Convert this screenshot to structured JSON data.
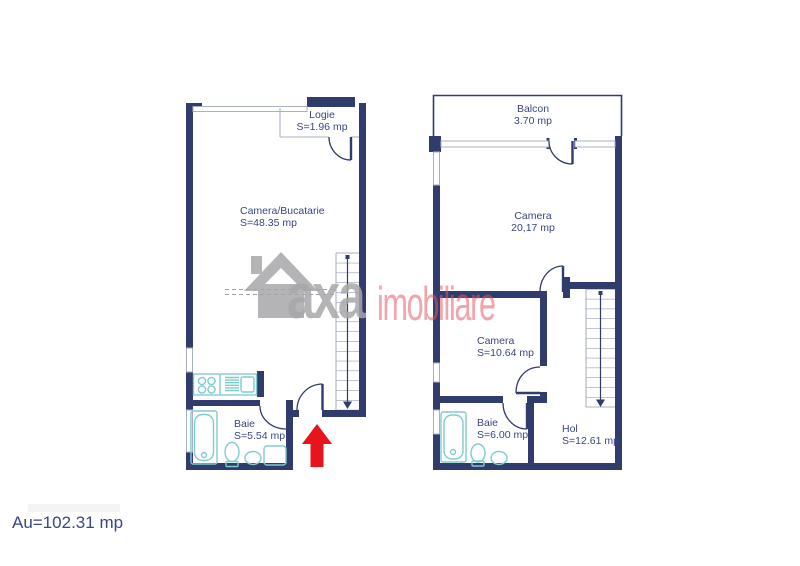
{
  "footer": {
    "total_area": "Au=102.31 mp"
  },
  "watermark": {
    "icon": "house-icon",
    "brand_primary": "axa",
    "brand_secondary": "imobiliare"
  },
  "entrance": {
    "icon": "up-arrow-icon",
    "color": "#e8141c"
  },
  "plans": {
    "lower": {
      "name": "lower-floor-plan",
      "rooms": [
        {
          "id": "logie",
          "label": "Logie",
          "area": "S=1.96 mp"
        },
        {
          "id": "camera_bucatarie",
          "label": "Camera/Bucatarie",
          "area": "S=48.35 mp"
        },
        {
          "id": "baie",
          "label": "Baie",
          "area": "S=5.54 mp"
        }
      ]
    },
    "upper": {
      "name": "upper-floor-plan",
      "rooms": [
        {
          "id": "balcon",
          "label": "Balcon",
          "area": "3.70 mp"
        },
        {
          "id": "camera_mare",
          "label": "Camera",
          "area": "20,17 mp"
        },
        {
          "id": "camera_mica",
          "label": "Camera",
          "area": "S=10.64 mp"
        },
        {
          "id": "baie",
          "label": "Baie",
          "area": "S=6.00 mp"
        },
        {
          "id": "hol",
          "label": "Hol",
          "area": "S=12.61 mp"
        }
      ]
    }
  },
  "colors": {
    "wall-color": "#303c6b",
    "line-color": "#a9b0c4",
    "tread-color": "#7e86a8",
    "fixture-color": "#7fccce",
    "text-color": "#3a4584",
    "arrow-color": "#e8141c",
    "wm-gray": "#a8a8aa"
  }
}
